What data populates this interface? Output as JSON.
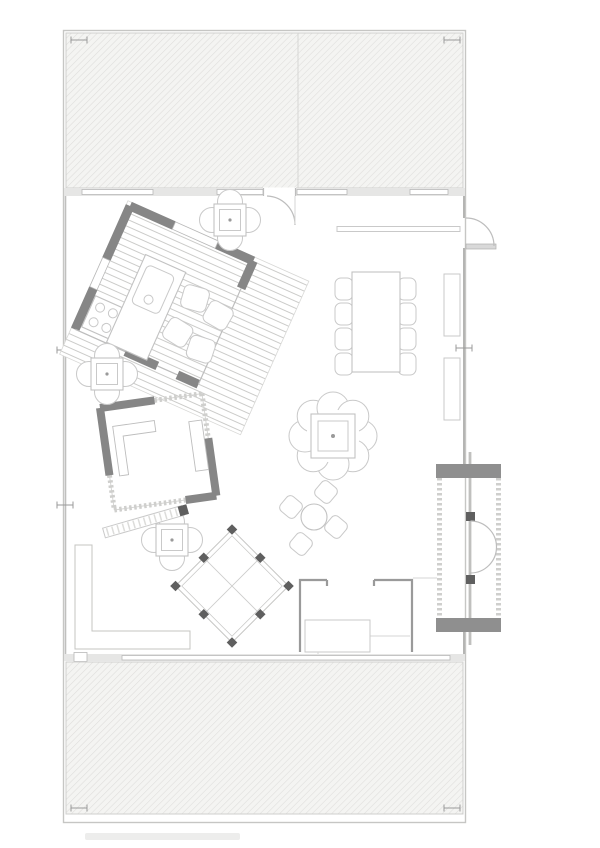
{
  "document": {
    "kind": "architectural-floor-plan",
    "background": "#ffffff",
    "visible_text": []
  },
  "palette": {
    "outline": "#c4c4c4",
    "thin_line": "#bdbdbd",
    "faint_line": "#d6d6d4",
    "wall_dark": "#868686",
    "wall_medium": "#9a9a9a",
    "post_dark": "#5f5f5f",
    "hatch_background": "#f4f4f2",
    "hatch_line": "#dededc",
    "deck_stripe": "#cbcbc9",
    "wall_band": "#e6e6e5",
    "door_leaf": "#d9d9d9"
  },
  "plan": {
    "terraces": {
      "count": 2,
      "fill_pattern": "diagonal-hatch",
      "positions": [
        "top",
        "bottom"
      ]
    },
    "rotated_pavilions": {
      "count": 2,
      "kitchen_pavilion_rotation_deg": 24,
      "second_pavilion_rotation_deg": -8
    },
    "dining_set": {
      "chairs": 8,
      "table_shape": "rectangle"
    },
    "round_tables_four_chairs": 3,
    "fireplace_scallops": 8,
    "pergola_posts": 8,
    "vestibule_doors": 2,
    "cooktop_burners": 4
  }
}
